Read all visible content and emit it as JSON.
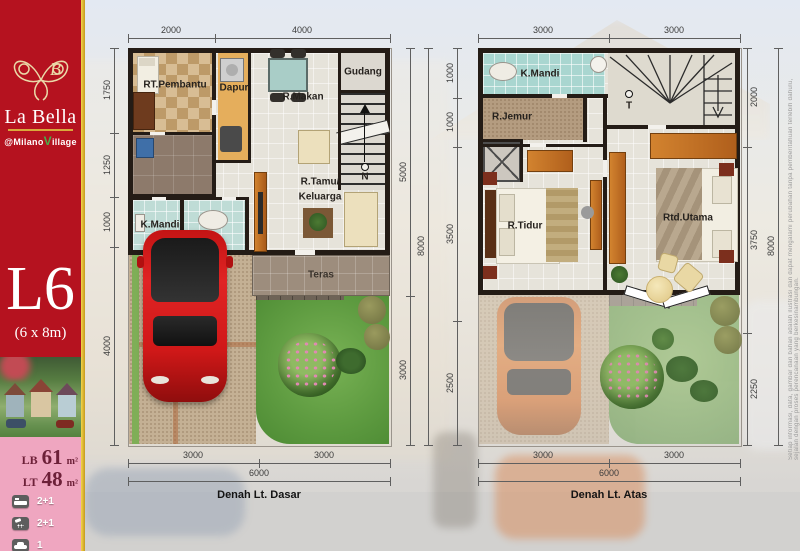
{
  "sidebar": {
    "brand_title": "La Bella",
    "brand_sub_pre": "@Milano",
    "brand_sub_v": "V",
    "brand_sub_rest": "illage",
    "unit_code": "L6",
    "unit_size": "(6 x 8m)",
    "stats": [
      {
        "label": "LB",
        "value": "61",
        "unit": "m²"
      },
      {
        "label": "LT",
        "value": "48",
        "unit": "m²"
      }
    ],
    "features": [
      {
        "icon": "bed-icon",
        "value": "2+1"
      },
      {
        "icon": "shower-icon",
        "value": "2+1"
      },
      {
        "icon": "car-icon",
        "value": "1"
      }
    ]
  },
  "ground_floor": {
    "title": "Denah Lt. Dasar",
    "dims_top": [
      "2000",
      "4000"
    ],
    "dims_left": [
      "1750",
      "1250",
      "1000",
      "4000"
    ],
    "dims_right": [
      "5000",
      "3000"
    ],
    "dim_right_total": "8000",
    "dims_bottom": [
      "3000",
      "3000"
    ],
    "dim_bottom_total": "6000",
    "north_label": "N",
    "rooms": {
      "pembantu": "RT.Pembantu",
      "dapur": "Dapur",
      "makan": "R.Makan",
      "gudang": "Gudang",
      "mandi": "K.Mandi",
      "tamu_line1": "R.Tamu/",
      "tamu_line2": "Keluarga",
      "teras": "Teras"
    }
  },
  "upper_floor": {
    "title": "Denah Lt. Atas",
    "dims_top": [
      "3000",
      "3000"
    ],
    "dims_left": [
      "1000",
      "1000",
      "3500",
      "2500"
    ],
    "dims_right": [
      "2000",
      "3750",
      "2250"
    ],
    "dim_right_total": "8000",
    "dims_bottom": [
      "3000",
      "3000"
    ],
    "dim_bottom_total": "6000",
    "stairs_label": "T",
    "rooms": {
      "mandi": "K.Mandi",
      "jemur": "R.Jemur",
      "tidur": "R.Tidur",
      "utama": "Rtd.Utama"
    }
  },
  "disclaimer": "Setiap informasi, data, gambar dan bahan adalah ilustrasi dan dapat mengalami perubahan tanpa pemberitahuan terlebih dahulu, sejalan dengan proses perencanaan yang berkesinambungan.",
  "colors": {
    "brand_red": "#b5121f",
    "brand_gold": "#e3ba2f",
    "brand_pink": "#efa6c0",
    "wall": "#241c16",
    "garden_green": "#5f9c41",
    "wood_accent": "#c06a28"
  }
}
